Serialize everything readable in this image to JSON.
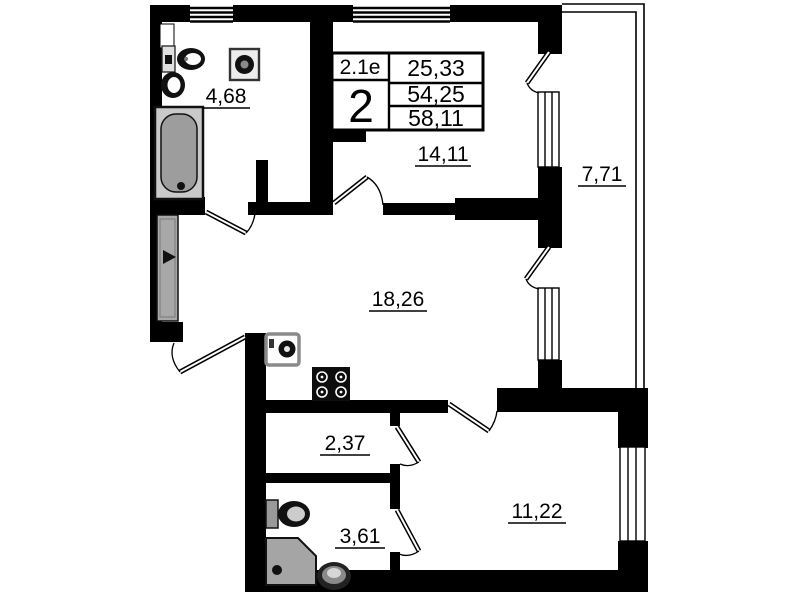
{
  "floor_plan": {
    "title_block": {
      "layout_code": "2.1е",
      "room_count": "2",
      "area_living": "25,33",
      "area_main": "54,25",
      "area_total": "58,11"
    },
    "room_areas": {
      "bathroom_top": "4,68",
      "bedroom_top": "14,11",
      "balcony": "7,71",
      "living_room": "18,26",
      "hall": "2,37",
      "bathroom_bottom": "3,61",
      "bedroom_bottom": "11,22"
    }
  }
}
